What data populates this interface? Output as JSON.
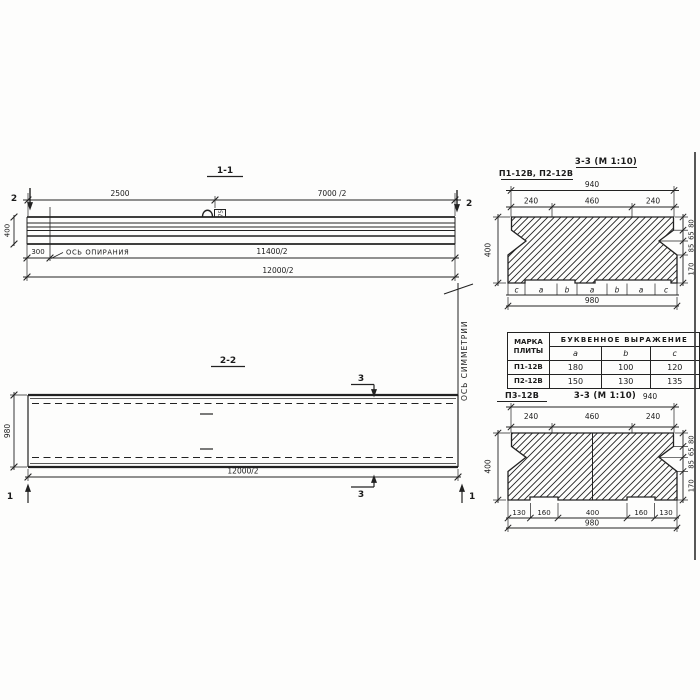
{
  "section11": {
    "title": "1-1",
    "dim_2500": "2500",
    "dim_7000": "7000 /2",
    "marker_left": "2",
    "marker_right": "2",
    "dim_height": "400",
    "dim_300": "300",
    "support_axis_label": "ОСЬ ОПИРАНИЯ",
    "dim_11400": "11400/2",
    "dim_12000": "12000/2",
    "loop_tag": "75"
  },
  "symmetry": {
    "label": "ОСЬ СИММЕТРИИ"
  },
  "section22": {
    "title": "2-2",
    "dim_width": "980",
    "dim_length": "12000/2",
    "marker3_top": "3",
    "marker3_bottom": "3",
    "marker1_left": "1",
    "marker1_right": "1"
  },
  "crossTop": {
    "label": "П1-12В, П2-12В",
    "title": "3-3 (М 1:10)",
    "dim_940": "940",
    "dim_240l": "240",
    "dim_460": "460",
    "dim_240r": "240",
    "dim_400": "400",
    "right_dims": [
      "80",
      "65",
      "85",
      "170"
    ],
    "letters": [
      "c",
      "a",
      "b",
      "a",
      "b",
      "a",
      "c"
    ],
    "dim_980": "980"
  },
  "table": {
    "h_mark1": "МАРКА",
    "h_mark2": "ПЛИТЫ",
    "h_expr": "БУКВЕННОЕ  ВЫРАЖЕНИЕ",
    "cols": [
      "a",
      "b",
      "c"
    ],
    "rows": [
      {
        "mark": "П1-12В",
        "a": "180",
        "b": "100",
        "c": "120"
      },
      {
        "mark": "П2-12В",
        "a": "150",
        "b": "130",
        "c": "135"
      }
    ]
  },
  "crossBottom": {
    "label": "П3-12В",
    "title": "3-3 (М 1:10)",
    "dim_940": "940",
    "dim_240l": "240",
    "dim_460": "460",
    "dim_240r": "240",
    "dim_400": "400",
    "right_dims": [
      "80",
      "65",
      "85",
      "170"
    ],
    "bottom_dims": [
      "130",
      "160",
      "400",
      "160",
      "130"
    ],
    "dim_980": "980"
  }
}
